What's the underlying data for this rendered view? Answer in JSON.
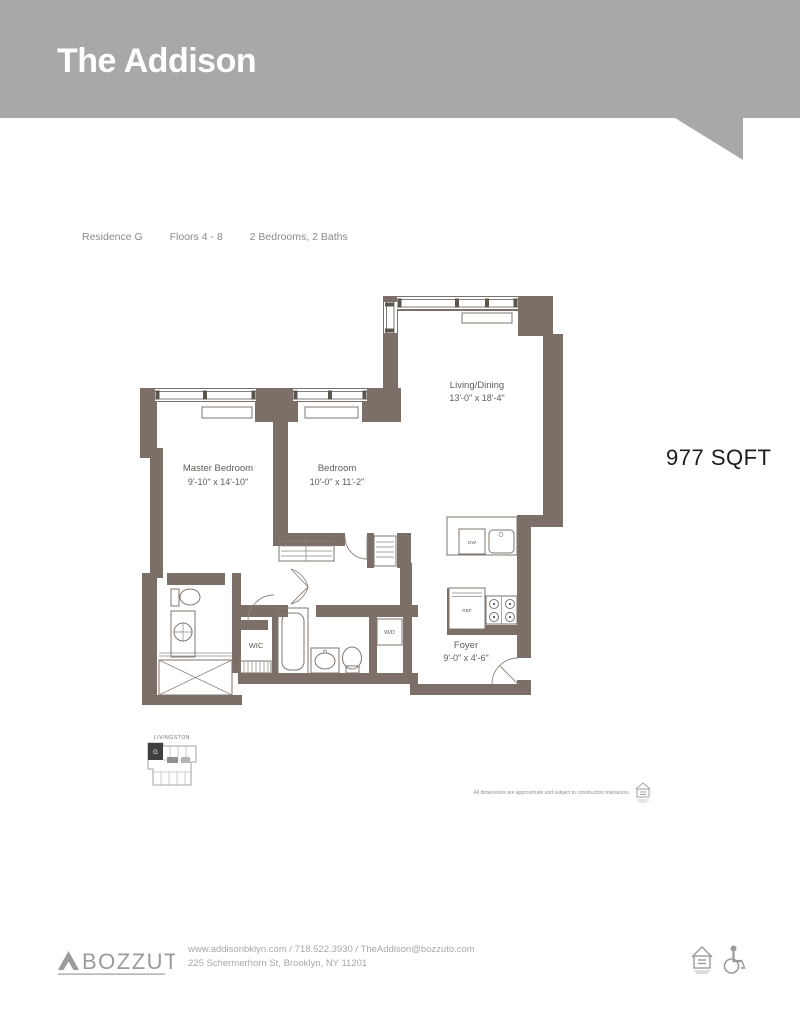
{
  "colors": {
    "header_bg": "#a8a8aa",
    "wall": "#7b6f68",
    "unit_fill": "#3f3f3f",
    "text_dark": "#1c1c1c",
    "text_muted": "#8a8a8a",
    "footer_gray": "#a8a8a8"
  },
  "header": {
    "title": "The Addison"
  },
  "meta": {
    "residence": "Residence G",
    "floors": "Floors 4 - 8",
    "config": "2 Bedrooms, 2 Baths"
  },
  "area": {
    "sqft": "977 SQFT"
  },
  "plan": {
    "rooms": [
      {
        "name": "Living/Dining",
        "dims": "13'-0\" x 18'-4\""
      },
      {
        "name": "Master Bedroom",
        "dims": "9'-10\" x 14'-10\""
      },
      {
        "name": "Bedroom",
        "dims": "10'-0\" x 11'-2\""
      },
      {
        "name": "Foyer",
        "dims": "9'-0\" x 4'-6\""
      }
    ],
    "fixtures": {
      "wic": "WIC",
      "wd": "W/D",
      "dw": "DW",
      "ref": "REF"
    }
  },
  "keyplan": {
    "street": "LIVINGSTON",
    "unit": "G"
  },
  "disclaimer": "All dimensions are approximate and subject to construction tolerances.",
  "footer": {
    "brand": "BOZZUTO",
    "contact_line1": "www.addisonbklyn.com / 718.522.3930 / TheAddison@bozzuto.com",
    "contact_line2": "225 Schermerhorn St, Brooklyn, NY 11201"
  },
  "icons": {
    "equal_housing": "house-with-equal-sign",
    "accessibility": "wheelchair"
  }
}
